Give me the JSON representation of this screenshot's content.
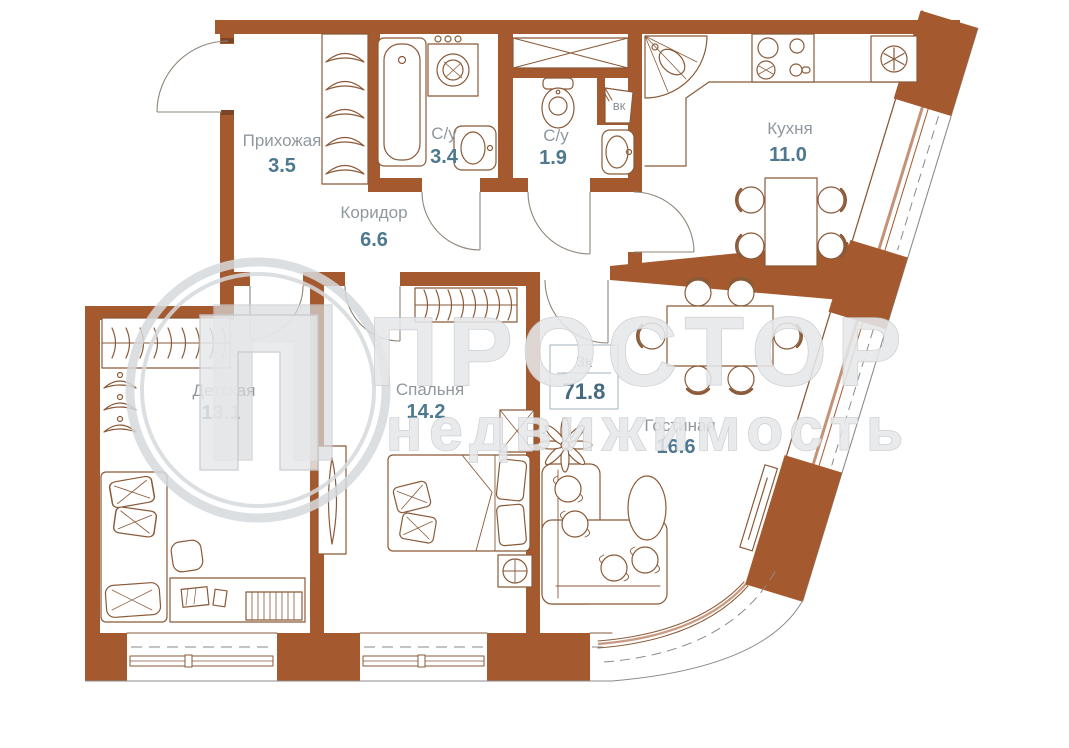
{
  "plan": {
    "rooms": [
      {
        "name": "Прихожая",
        "area": "3.5"
      },
      {
        "name": "С/у",
        "area": "3.4"
      },
      {
        "name": "С/у",
        "area": "1.9"
      },
      {
        "name": "Коридор",
        "area": "6.6"
      },
      {
        "name": "Кухня",
        "area": "11.0"
      },
      {
        "name": "Детская",
        "area": "13.1"
      },
      {
        "name": "Спальня",
        "area": "14.2"
      },
      {
        "name": "Гостиная",
        "area": "16.6"
      }
    ],
    "summary": {
      "type": "3к",
      "total_area": "71.8"
    },
    "labels": {
      "vent_shaft": "вк"
    },
    "colors": {
      "wall": "#a5592e",
      "furniture_line": "#8a5a38",
      "room_name": "#90989e",
      "room_area": "#4d7890",
      "watermark": "#e6e8ea"
    }
  },
  "watermark": {
    "line1": "ПРОСТОР",
    "line2": "недвижимость",
    "logo_letter": "П"
  }
}
